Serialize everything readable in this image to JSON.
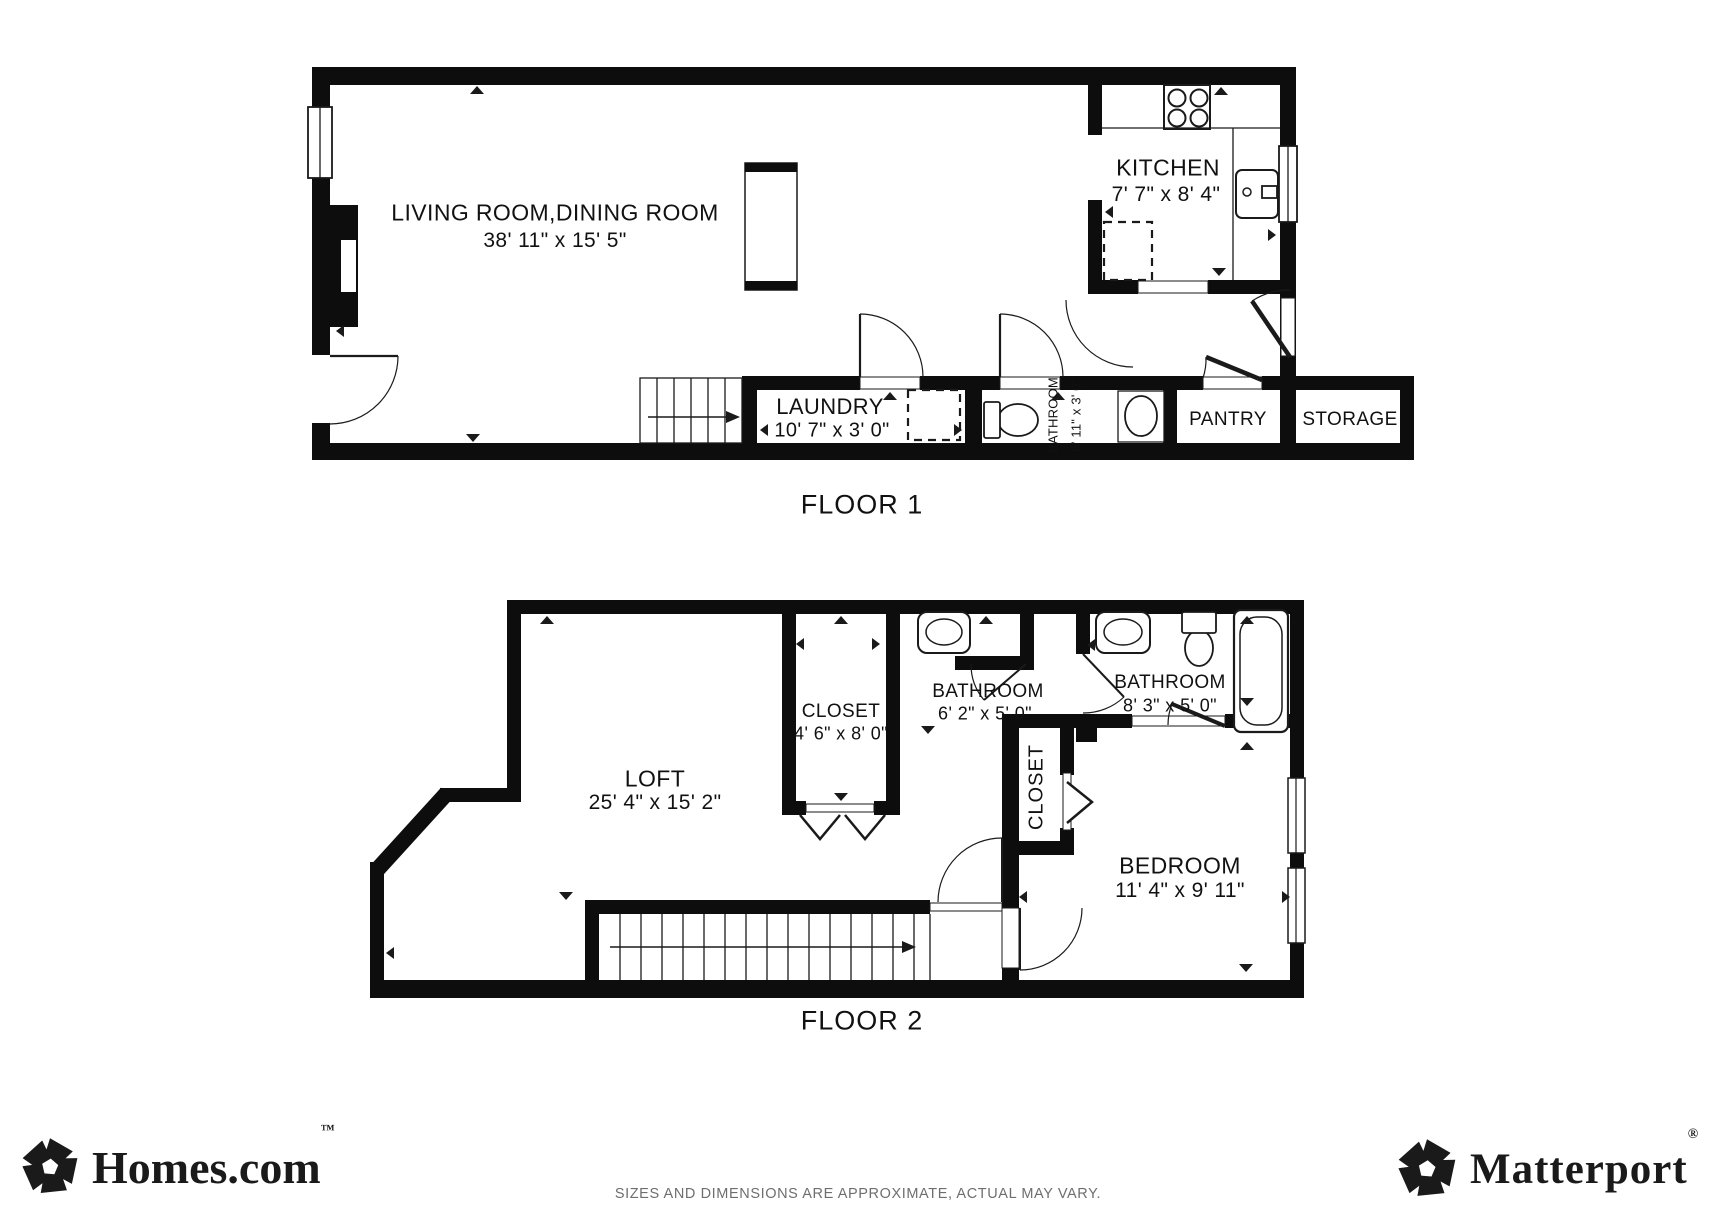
{
  "floor1": {
    "label": "FLOOR 1",
    "living_name": "LIVING ROOM,DINING ROOM",
    "living_dims": "38' 11\" x 15' 5\"",
    "kitchen_name": "KITCHEN",
    "kitchen_dims": "7' 7\" x 8' 4\"",
    "laundry_name": "LAUNDRY",
    "laundry_dims": "10' 7\" x 3' 0\"",
    "bathroom_name": "BATHROOM",
    "bathroom_dims": "5' 11\" x 3' 0\"",
    "pantry_name": "PANTRY",
    "storage_name": "STORAGE"
  },
  "floor2": {
    "label": "FLOOR 2",
    "loft_name": "LOFT",
    "loft_dims": "25' 4\" x 15' 2\"",
    "closet_name": "CLOSET",
    "closet_dims": "4' 6\" x 8' 0\"",
    "bathroom1_name": "BATHROOM",
    "bathroom1_dims": "6' 2\" x 5' 0\"",
    "bathroom2_name": "BATHROOM",
    "bathroom2_dims": "8' 3\" x 5' 0\"",
    "closet2_name": "CLOSET",
    "bedroom_name": "BEDROOM",
    "bedroom_dims": "11' 4\" x 9' 11\""
  },
  "footer": {
    "left_logo": "Homes.com",
    "left_logo_mark": "™",
    "left_logo_icon": "homes-pinwheel-icon",
    "right_logo": "Matterport",
    "right_logo_mark": "®",
    "right_logo_icon": "matterport-pinwheel-icon",
    "disclaimer": "SIZES AND DIMENSIONS ARE APPROXIMATE, ACTUAL MAY VARY."
  },
  "colors": {
    "wall": "#0d0d0d",
    "label_text": "#111111",
    "disclaimer_text": "#6e6e6e",
    "logo": "#1a1a1a"
  }
}
